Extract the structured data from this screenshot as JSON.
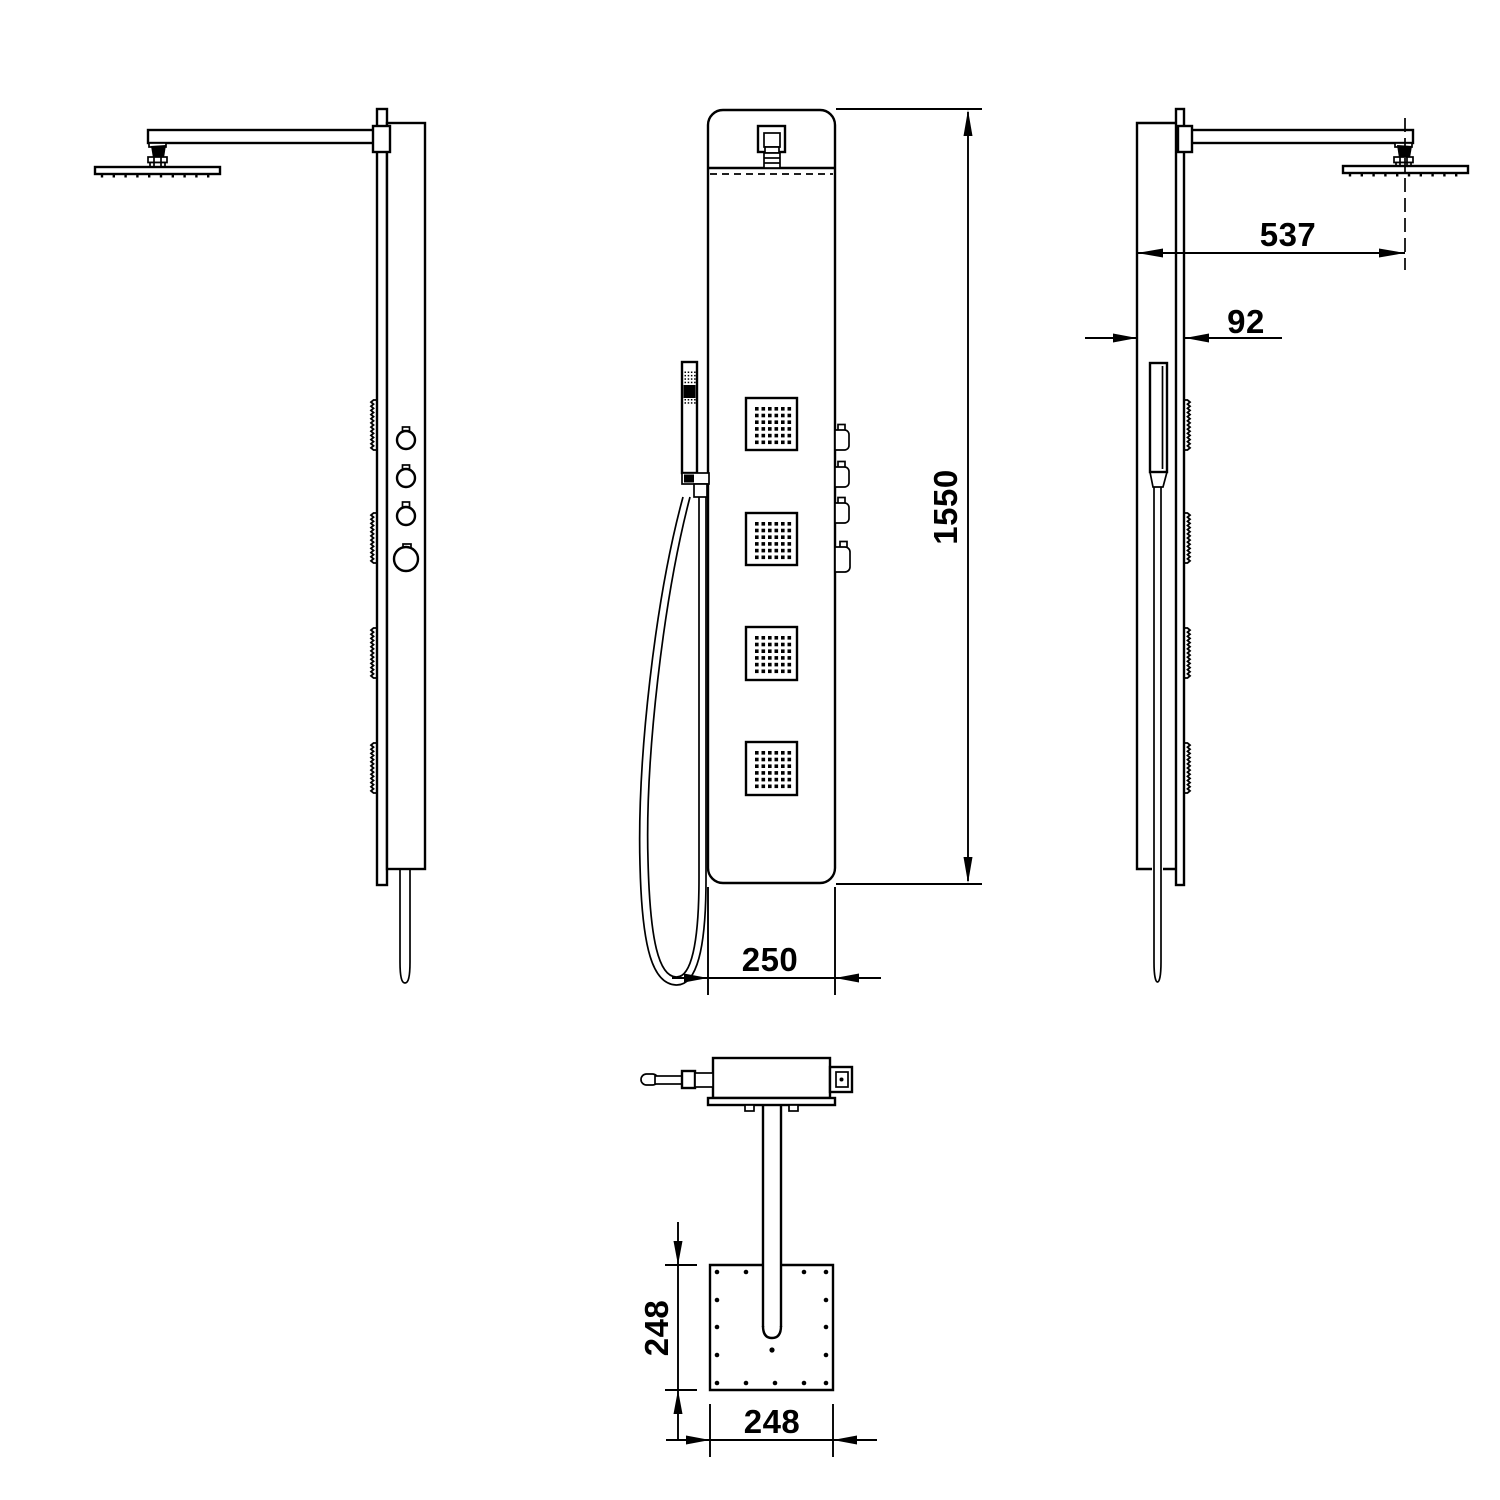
{
  "drawing": {
    "colors": {
      "line": "#000000",
      "background": "#ffffff"
    },
    "dimensions": {
      "arm_projection": "537",
      "panel_depth": "92",
      "overall_height": "1550",
      "panel_width": "250",
      "head_depth": "248",
      "head_width": "248"
    }
  }
}
